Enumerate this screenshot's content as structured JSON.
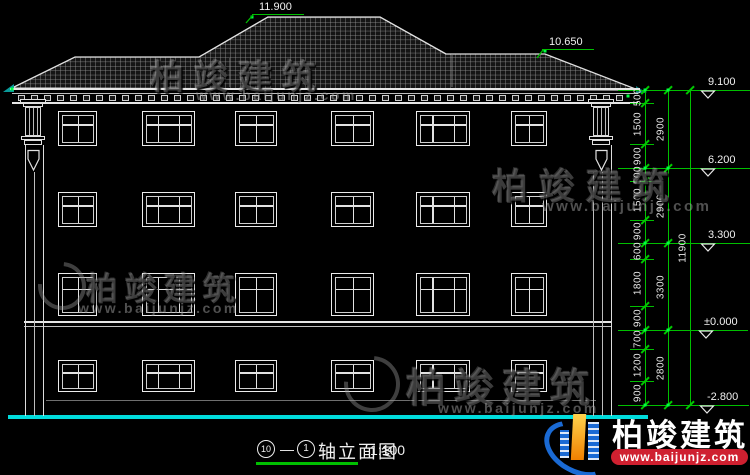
{
  "drawing": {
    "peak_label": "11.900",
    "side_ridge_label": "10.650",
    "levels": [
      {
        "value": "9.100"
      },
      {
        "value": "6.200"
      },
      {
        "value": "3.300"
      },
      {
        "value": "±0.000"
      },
      {
        "value": "-2.800"
      }
    ],
    "dims": {
      "segments": [
        "500",
        "1500",
        "900",
        "500",
        "1500",
        "900",
        "600",
        "1800",
        "900",
        "700",
        "1200",
        "900"
      ],
      "floors": [
        "2900",
        "2900",
        "3300",
        "2800"
      ],
      "total": "11900"
    }
  },
  "title": {
    "axis_start": "10",
    "axis_sep": "—",
    "axis_end": "1",
    "label": "轴立面图",
    "scale": "1:100"
  },
  "watermark": {
    "brand": "柏竣建筑",
    "url": "www.baijunjz.com"
  },
  "logo": {
    "brand": "柏竣建筑",
    "url": "www.baijunjz.com"
  },
  "colors": {
    "dim_green": "#00bf00",
    "ground_cyan": "#00dcdc",
    "logo_blue": "#1a6ad4",
    "logo_orange": "#f08000",
    "logo_red": "#cf2030"
  }
}
